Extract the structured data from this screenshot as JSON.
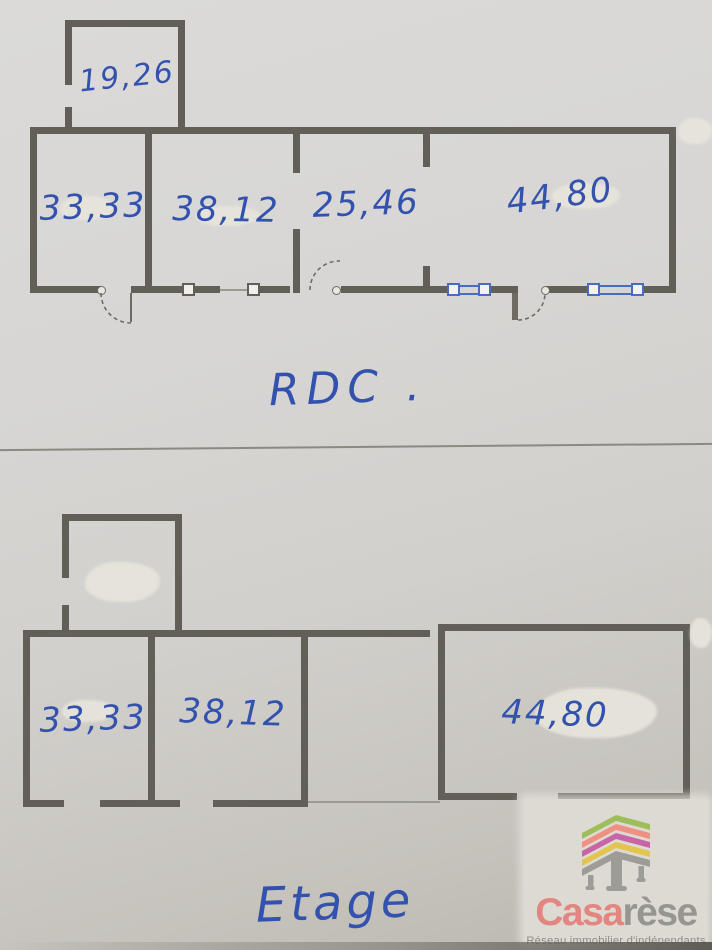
{
  "document": {
    "type": "hand-annotated floor plan sketch",
    "floors": [
      {
        "id": "rdc",
        "label": "RDC .",
        "rooms": [
          {
            "name": "annexe-haut",
            "area": "19,26"
          },
          {
            "name": "piece-1",
            "area": "33,33"
          },
          {
            "name": "piece-2",
            "area": "38,12"
          },
          {
            "name": "piece-3",
            "area": "25,46"
          },
          {
            "name": "piece-4",
            "area": "44,80"
          }
        ]
      },
      {
        "id": "etage",
        "label": "Etage",
        "rooms": [
          {
            "name": "piece-1",
            "area": "33,33"
          },
          {
            "name": "piece-2",
            "area": "38,12"
          },
          {
            "name": "piece-3",
            "area": "44,80"
          }
        ]
      }
    ]
  },
  "logo": {
    "brand_primary": "Casa",
    "brand_secondary": "rèse",
    "tagline": "Réseau immobilier d'indépendants",
    "icon": "stacked-roof-building-icon"
  },
  "colors": {
    "ink_blue": "#3352ad",
    "wall_gray": "#615f57",
    "window_blue": "#4a6cc0",
    "paper": "#d6d5d2",
    "brand_primary": "#e18680",
    "brand_secondary": "#97958f",
    "logo_green": "#a0bd5b",
    "logo_salmon": "#ee9082",
    "logo_pink": "#c765a5",
    "logo_yellow": "#e2c54e",
    "logo_gray": "#9e9c97"
  }
}
